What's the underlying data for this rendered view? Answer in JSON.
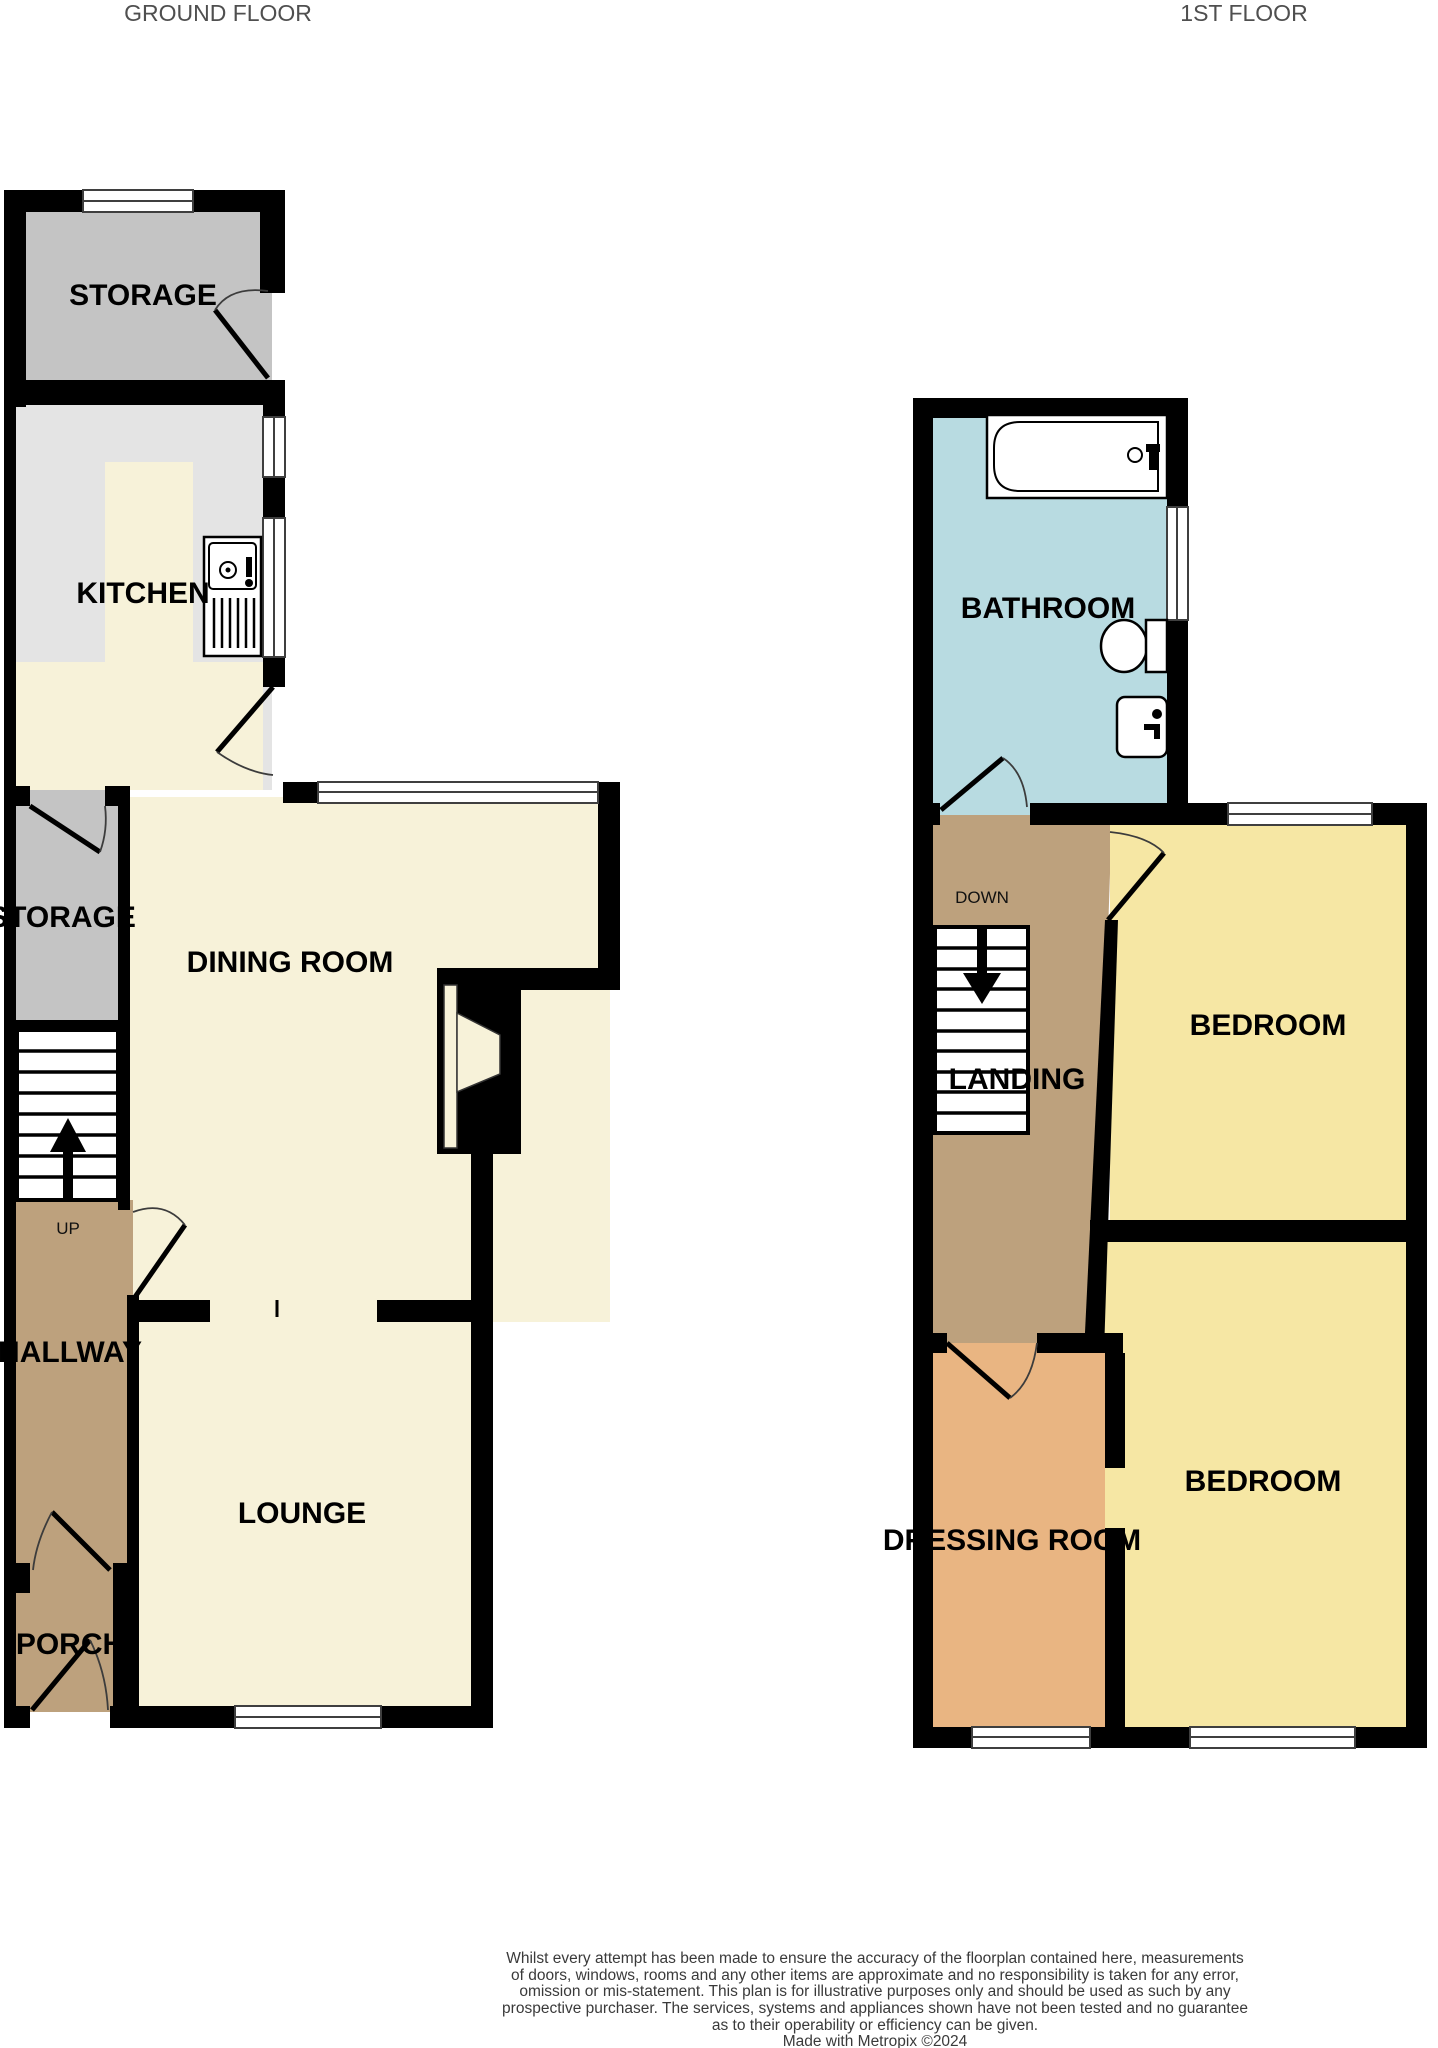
{
  "titles": {
    "ground": "GROUND FLOOR",
    "first": "1ST FLOOR"
  },
  "floors": {
    "ground": {
      "rooms": [
        {
          "id": "storage-top",
          "label": "STORAGE"
        },
        {
          "id": "kitchen",
          "label": "KITCHEN"
        },
        {
          "id": "storage-mid",
          "label": "STORAGE"
        },
        {
          "id": "dining-room",
          "label": "DINING ROOM"
        },
        {
          "id": "hallway",
          "label": "HALLWAY"
        },
        {
          "id": "lounge",
          "label": "LOUNGE"
        },
        {
          "id": "porch",
          "label": "PORCH"
        }
      ],
      "stair_direction": "UP"
    },
    "first": {
      "rooms": [
        {
          "id": "bathroom",
          "label": "BATHROOM"
        },
        {
          "id": "landing",
          "label": "LANDING"
        },
        {
          "id": "bedroom-1",
          "label": "BEDROOM"
        },
        {
          "id": "dressing-room",
          "label": "DRESSING ROOM"
        },
        {
          "id": "bedroom-2",
          "label": "BEDROOM"
        }
      ],
      "stair_direction": "DOWN"
    }
  },
  "colors": {
    "wall": "#000000",
    "storage": "#c4c4c4",
    "kitchen_floor": "#e4e4e4",
    "cream": "#f7f2d9",
    "tan": "#bda17d",
    "bathroom_blue": "#b8dbe1",
    "bedroom_yellow": "#f6e7a4",
    "dressing_orange": "#e9b582",
    "floor_title_text": "#4f4f4f",
    "disclaimer_text": "#3a3a3a"
  },
  "disclaimer": {
    "lines": [
      "Whilst every attempt has been made to ensure the accuracy of the floorplan contained here, measurements",
      "of doors, windows, rooms and any other items are approximate and no responsibility is taken for any error,",
      "omission or mis-statement. This plan is for illustrative purposes only and should be used as such by any",
      "prospective purchaser. The services, systems and appliances shown have not been tested and no guarantee",
      "as to their operability or efficiency can be given.",
      "Made with Metropix ©2024"
    ]
  }
}
